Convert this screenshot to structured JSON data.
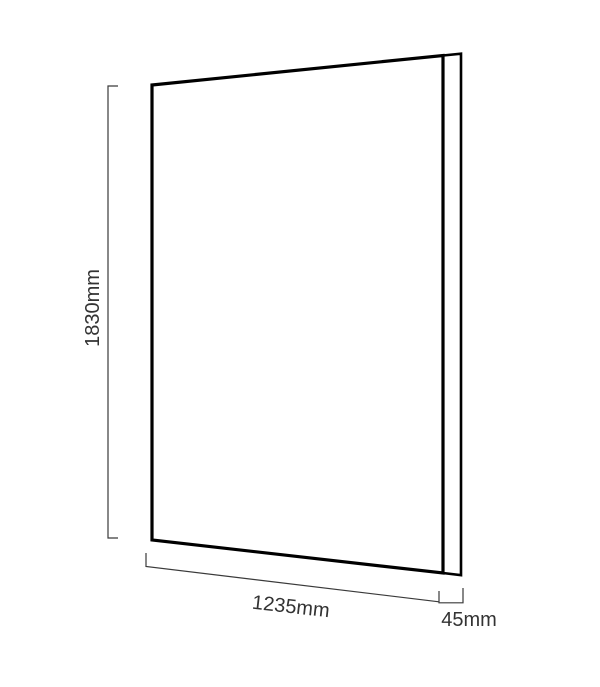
{
  "diagram": {
    "name": "panel-dimension-diagram",
    "shape": "rectangular-panel-perspective",
    "dimensions": {
      "height": {
        "label": "1830mm",
        "value": 1830,
        "unit": "mm"
      },
      "width": {
        "label": "1235mm",
        "value": 1235,
        "unit": "mm"
      },
      "thickness": {
        "label": "45mm",
        "value": 45,
        "unit": "mm"
      }
    },
    "colors": {
      "background": "#ffffff",
      "outline": "#000000",
      "dimension_lines": "#3a3a3a",
      "label_text": "#333333",
      "panel_fill": "#ffffff"
    }
  }
}
